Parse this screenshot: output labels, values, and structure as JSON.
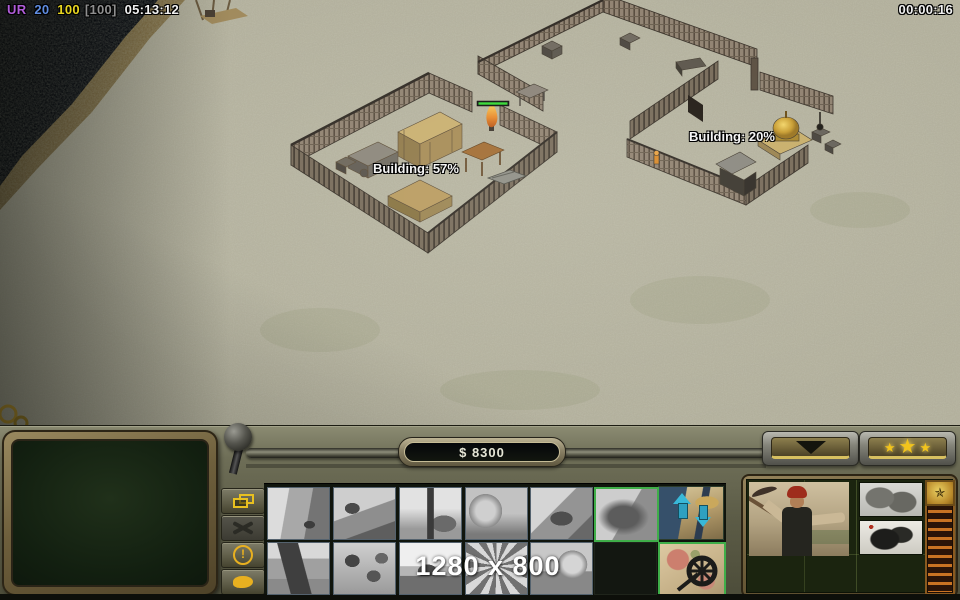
{
  "top_bar": {
    "faction_tag": "UR",
    "unit_count": "20",
    "power_current": "100",
    "power_max": "[100]",
    "session_clock": "05:13:12",
    "match_timer": "00:00:16",
    "colors": {
      "faction_tag": "#b05cd8",
      "unit_count": "#5f8ce0",
      "power_current": "#e8d620",
      "power_max": "#8f8f8f",
      "clock": "#f0f0f0"
    }
  },
  "map": {
    "labels": [
      {
        "text": "Building: 57%"
      },
      {
        "text": "Building: 20%"
      }
    ],
    "health_bar_color": "#30d830",
    "terrain_base_color": "#b2af9c",
    "water_color": "#070b12"
  },
  "control_bar": {
    "money_display": "$ 8300",
    "resolution_watermark": "1280 x 800",
    "accent_gold": "#e8b820",
    "star_glyph": "★",
    "side_buttons": [
      {
        "name": "select-structures-button",
        "icon": "overlapping-frames-icon",
        "state": "enabled"
      },
      {
        "name": "sell-button",
        "icon": "crossed-tools-icon",
        "state": "disabled"
      },
      {
        "name": "alert-button",
        "icon": "exclamation-circle-icon",
        "state": "enabled"
      },
      {
        "name": "chat-button",
        "icon": "speech-bubble-icon",
        "state": "enabled"
      }
    ],
    "options_button": {
      "name": "options-button",
      "icon": "down-triangle-icon"
    },
    "general_promotion_button": {
      "name": "general-promotion-button",
      "icon": "three-stars-icon"
    },
    "build_palette": {
      "selected_border_color": "#3fae49",
      "row1": [
        {
          "name": "build-option-1",
          "state": "disabled"
        },
        {
          "name": "build-option-2",
          "state": "disabled"
        },
        {
          "name": "build-option-3",
          "state": "disabled"
        },
        {
          "name": "build-option-4",
          "state": "disabled"
        },
        {
          "name": "build-option-5",
          "state": "disabled"
        },
        {
          "name": "build-option-6",
          "state": "selected"
        }
      ],
      "row2": [
        {
          "name": "build-option-7",
          "state": "disabled"
        },
        {
          "name": "build-option-8",
          "state": "disabled"
        },
        {
          "name": "build-option-9",
          "state": "disabled"
        },
        {
          "name": "build-option-10",
          "state": "disabled"
        },
        {
          "name": "build-option-11",
          "state": "disabled"
        }
      ],
      "command_icons": [
        {
          "name": "structure-up-down-arrows-command",
          "icon": "up-down-arrows-icon",
          "state": "enabled"
        },
        {
          "name": "map-wheel-command",
          "icon": "map-with-wheel-icon",
          "state": "selected"
        }
      ]
    },
    "unit_panel": {
      "portrait": "worker-with-pickaxe-portrait",
      "inventory_icons": [
        "sandals-icon",
        "boots-icon"
      ],
      "rank_ladder": "veterancy-rank-ladder",
      "rank_star": "veterancy-star-emblem"
    }
  }
}
